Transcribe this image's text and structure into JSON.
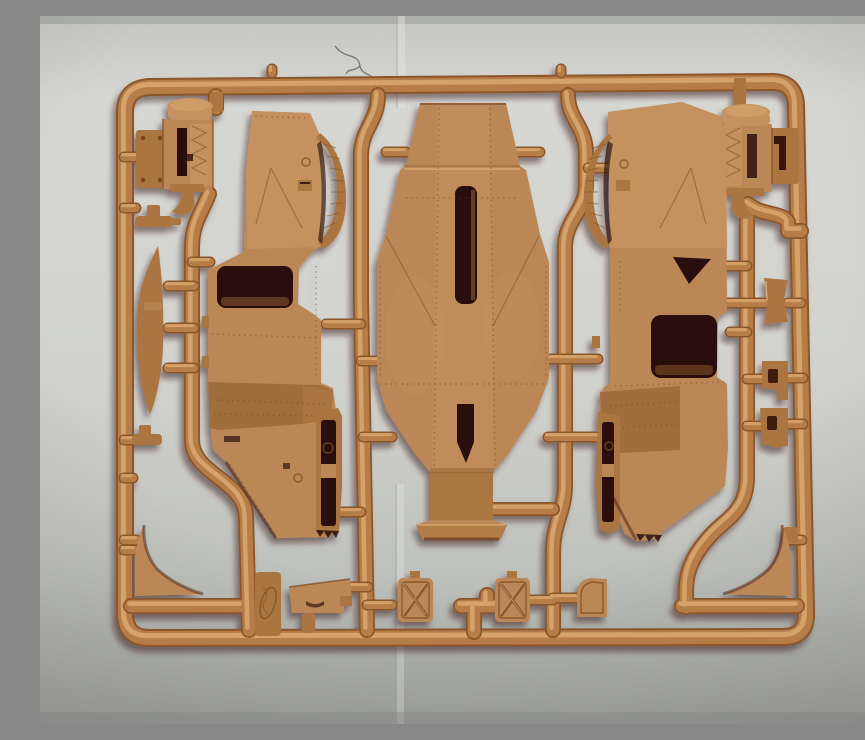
{
  "scene": {
    "type": "photograph",
    "subject": "Tan injection-molded plastic model-kit sprue with armored vehicle hull parts, photographed on light gray paper",
    "aria_label": "Photograph of a tan plastic model kit sprue holding molded armored-car parts: two hull side panels with window openings, a large riveted chassis floor, two engine blocks, hatch doors, mudflaps and small fittings, lying on a gray background"
  },
  "palette": {
    "background_top": "#d8d9d5",
    "background_bottom": "#a6a8a3",
    "plastic_base": "#b67d49",
    "plastic_highlight": "#d8a76d",
    "plastic_shadow": "#8a572c",
    "part_face": "#bc8757",
    "dark_band": "#a06e3d",
    "cavity_shadow": "#2a0f08",
    "photo_shadow": "#36120a"
  },
  "parts": [
    {
      "name": "sprue-frame"
    },
    {
      "name": "engine-block-left"
    },
    {
      "name": "engine-block-right"
    },
    {
      "name": "hull-side-panel-left"
    },
    {
      "name": "hull-side-panel-right"
    },
    {
      "name": "chassis-floor-center"
    },
    {
      "name": "fender-blade"
    },
    {
      "name": "mudflap-left"
    },
    {
      "name": "mudflap-right"
    },
    {
      "name": "hatch-door-x-1"
    },
    {
      "name": "hatch-door-x-2"
    },
    {
      "name": "stowage-box"
    },
    {
      "name": "curved-hatch"
    },
    {
      "name": "bowtie-bracket"
    },
    {
      "name": "hole-bracket-1"
    },
    {
      "name": "hole-bracket-2"
    },
    {
      "name": "axle-fitting-1"
    },
    {
      "name": "axle-fitting-2"
    },
    {
      "name": "embossed-tab"
    }
  ]
}
